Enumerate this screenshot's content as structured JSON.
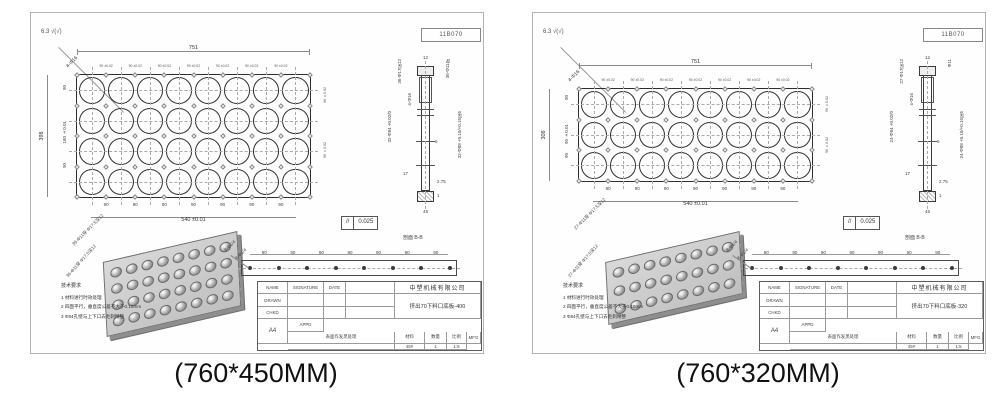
{
  "captions": {
    "left": "(760*450MM)",
    "right": "(760*320MM)"
  },
  "drawings": [
    {
      "drawing_number": "11B070",
      "surface_mark": "6.3 √(√)",
      "corner_leader": "4-Φ16",
      "plan": {
        "cols": 8,
        "rows": 4,
        "dim_top": "751",
        "pitch_label": "90 ±0.02",
        "pitch_bottom": "90",
        "dim_bottom": "540 ±0.01",
        "dim_left_total": "398",
        "left_inner_1": "90",
        "left_inner_2": "180 ±0.01",
        "left_inner_3": "90",
        "right_label_1": "90 ±0.02",
        "right_label_2": "90 ±0.02",
        "leader": "36-Φ11穿 Φ17.5深12"
      },
      "section": {
        "label": "剖面 B-B",
        "dim12": "12",
        "cb": "36-Φ17深12",
        "thru": "36-Φ11穿",
        "four": "4-Φ16",
        "bore_left": "32-Φ84 +0.02/0",
        "bore_right": "32-Φ88 +0.10/+0.15深5",
        "d5": "5",
        "d17": "17",
        "d275": "2.75",
        "d1": "1",
        "d45": "45",
        "fcf_sym": "//",
        "fcf_val": "0.025"
      },
      "iso_leader_left": "36-Φ11穿 Φ17.5深12",
      "iso_leader_right": "8-Φ1/4",
      "notes": {
        "title": "技术要求",
        "items": [
          "1  材料进行时效处理",
          "2  四面平行，垂直度公差不大于0.10mm",
          "3  Φ84孔壁与上下口去毛刺精整"
        ]
      },
      "strip": {
        "pitch": "90",
        "leader": "8-Φ1/4"
      },
      "title_block": {
        "company": "中塑机械有限公司",
        "part_name": "挤出70下料口底板-400",
        "h_name": "NAME",
        "h_sig": "SIGNATURE",
        "h_date": "DATE",
        "r_drawn": "DRAWN",
        "r_chkd": "CHKD",
        "r_appd": "APPD",
        "r_mfg": "MFG",
        "finish_note": "表面作发黑处理",
        "material_label": "材料",
        "material": "45#",
        "qty_label": "数量",
        "qty": "1",
        "scale_label": "比例",
        "scale": "1:5",
        "sheet": "A4"
      }
    },
    {
      "drawing_number": "11B070",
      "surface_mark": "6.3 √(√)",
      "corner_leader": "4-Φ16",
      "plan": {
        "cols": 8,
        "rows": 3,
        "dim_top": "751",
        "pitch_label": "90 ±0.02",
        "pitch_bottom": "90",
        "dim_bottom": "540 ±0.01",
        "dim_left_total": "308",
        "left_inner_1": "90",
        "left_inner_2": "90 ±0.01",
        "left_inner_3": "90",
        "right_label_1": "90 ±0.02",
        "right_label_2": "90 ±0.02",
        "leader": "27-Φ11穿 Φ17.5深12"
      },
      "section": {
        "label": "剖面 B-B",
        "dim12": "12",
        "cb": "27-Φ17深12",
        "thru": "Φ11",
        "four": "4-Φ16",
        "bore_left": "24-Φ84 +0.02/0",
        "bore_right": "24-Φ88 +0.10/+0.15深5",
        "d5": "5",
        "d17": "17",
        "d275": "2.75",
        "d1": "1",
        "d45": "45",
        "fcf_sym": "//",
        "fcf_val": "0.025"
      },
      "iso_leader_left": "27-Φ11穿 Φ17.5深12",
      "iso_leader_right": "8-Φ1/4",
      "notes": {
        "title": "技术要求",
        "items": [
          "1  材料进行时效处理",
          "2  四面平行，垂直度公差不大于0.10mm",
          "3  Φ84孔壁与上下口去毛刺精整"
        ]
      },
      "strip": {
        "pitch": "90",
        "leader": "8-Φ1/4"
      },
      "title_block": {
        "company": "中塑机械有限公司",
        "part_name": "挤出70下料口底板-320",
        "h_name": "NAME",
        "h_sig": "SIGNATURE",
        "h_date": "DATE",
        "r_drawn": "DRAWN",
        "r_chkd": "CHKD",
        "r_appd": "APPD",
        "r_mfg": "MFG",
        "finish_note": "表面作发黑处理",
        "material_label": "材料",
        "material": "45#",
        "qty_label": "数量",
        "qty": "1",
        "scale_label": "比例",
        "scale": "1:5",
        "sheet": "A4"
      }
    }
  ]
}
